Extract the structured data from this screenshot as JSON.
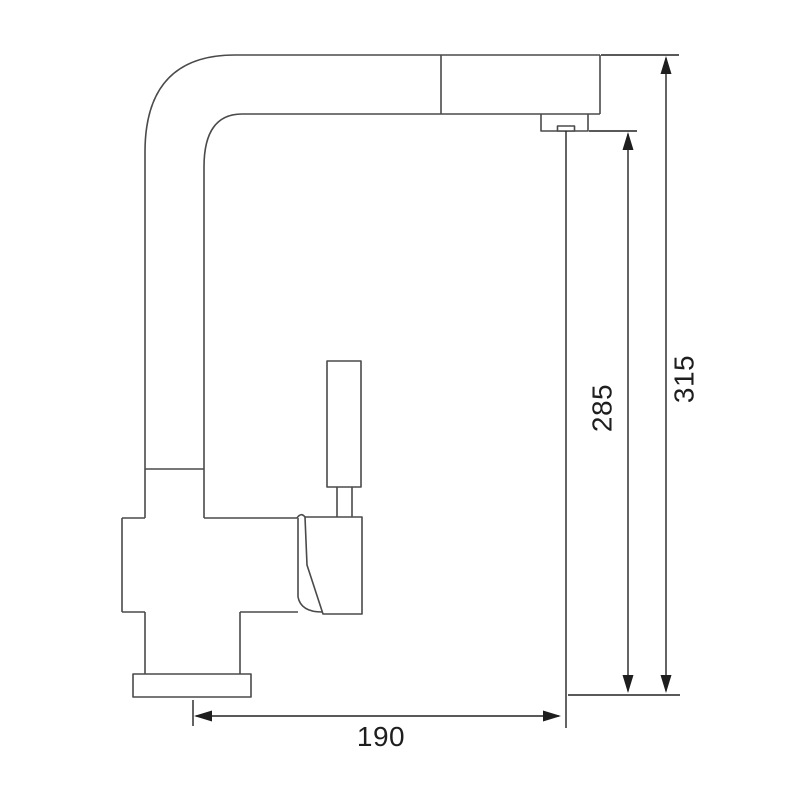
{
  "drawing": {
    "description": "faucet-side-profile-dimension-drawing",
    "labels": {
      "total_height": "315",
      "outlet_height": "285",
      "spout_reach": "190"
    },
    "colors": {
      "background": "#ffffff",
      "outline": "#4a4a4a",
      "dimension": "#222222",
      "text": "#1e1e1e"
    }
  }
}
